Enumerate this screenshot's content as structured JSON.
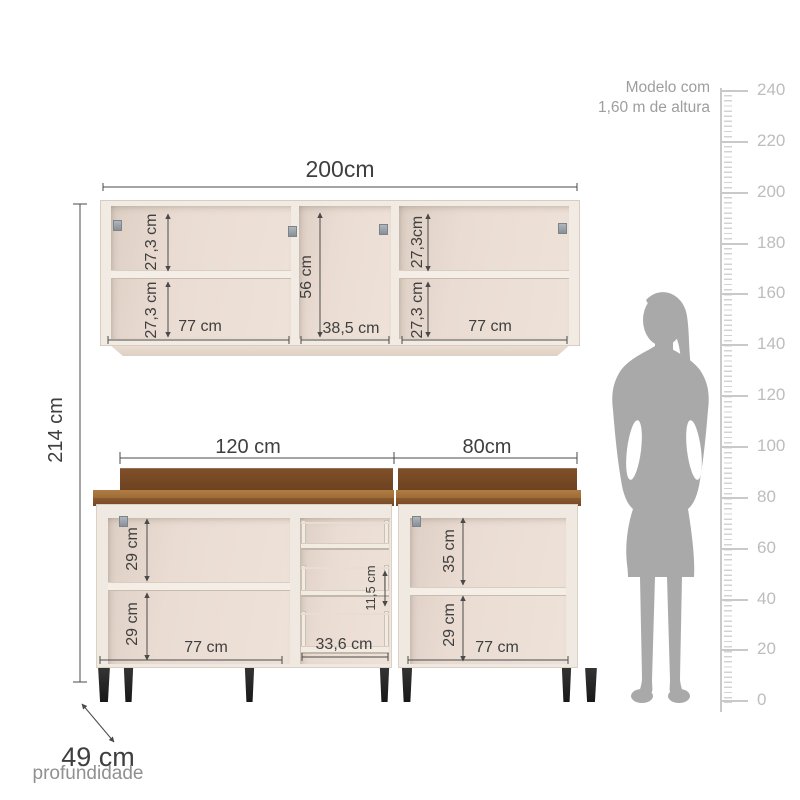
{
  "wall_cabinet": {
    "width_label": "200cm",
    "left_section": {
      "top_height": "27,3 cm",
      "bottom_height": "27,3 cm",
      "width": "77 cm"
    },
    "middle_section": {
      "height": "56 cm",
      "width": "38,5 cm"
    },
    "right_section": {
      "top_height": "27,3cm",
      "bottom_height": "27,3 cm",
      "width": "77 cm"
    }
  },
  "base_cabinet": {
    "left_width_label": "120 cm",
    "right_width_label": "80cm",
    "left_section": {
      "top_height": "29 cm",
      "bottom_height": "29 cm",
      "width": "77 cm"
    },
    "middle_section": {
      "tray_spacing": "11,5 cm",
      "width": "33,6 cm"
    },
    "right_section": {
      "top_height": "35 cm",
      "bottom_height": "29 cm",
      "width": "77 cm"
    }
  },
  "overall": {
    "height_label": "214 cm",
    "depth_label": "49 cm",
    "depth_caption": "profundidade"
  },
  "scale_figure": {
    "caption_line1": "Modelo com",
    "caption_line2": "1,60 m de altura"
  },
  "ruler": {
    "tick_labels": [
      "240",
      "220",
      "200",
      "180",
      "160",
      "140",
      "120",
      "100",
      "80",
      "60",
      "40",
      "20",
      "0"
    ]
  },
  "colors": {
    "counter_top": "#9c6c38",
    "counter_edge": "#7c4c24",
    "backsplash": "#7b4b26",
    "cabinet_body": "#f0e9e1",
    "cabinet_interior": "#e7dacf",
    "dimension_line": "#4a4a4a",
    "silhouette": "#a9a9a9",
    "ruler": "#c9c9c9",
    "leg": "#1f1f1f"
  }
}
